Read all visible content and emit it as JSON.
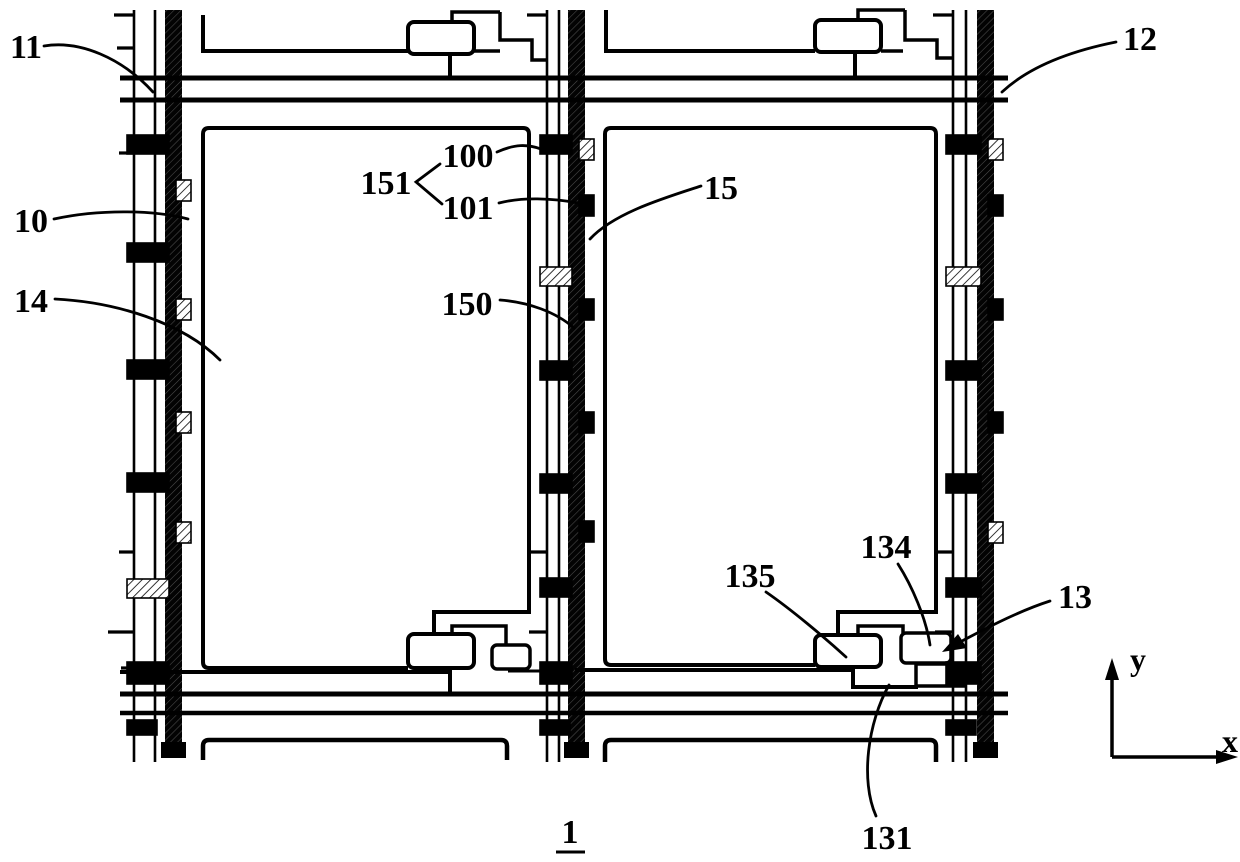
{
  "figure": {
    "number_label": "1",
    "axis_x": "x",
    "axis_y": "y"
  },
  "colors": {
    "ink": "#000000",
    "paper": "#ffffff"
  },
  "reference_labels": [
    {
      "id": "11",
      "text": "11",
      "cx": 26,
      "by": 58,
      "leader": "M 44,46 C 80,40 122,58 153,92"
    },
    {
      "id": "12",
      "text": "12",
      "cx": 1140,
      "by": 50,
      "leader": "M 1116,42 C 1076,50 1032,64 1002,92"
    },
    {
      "id": "10",
      "text": "10",
      "cx": 31,
      "by": 232,
      "leader": "M 54,219 C 100,209 155,210 188,219"
    },
    {
      "id": "14",
      "text": "14",
      "cx": 31,
      "by": 312,
      "leader": "M 55,299 C 115,302 182,322 220,360"
    },
    {
      "id": "151",
      "text": "151",
      "cx": 386,
      "by": 194,
      "leader": "M 440,164 L 416,182 L 442,204"
    },
    {
      "id": "100",
      "text": "100",
      "cx": 468,
      "by": 167,
      "leader": "M 497,152 C 515,144 527,144 541,149"
    },
    {
      "id": "101",
      "text": "101",
      "cx": 468,
      "by": 219,
      "leader": "M 499,203 C 522,197 552,198 578,203"
    },
    {
      "id": "15",
      "text": "15",
      "cx": 721,
      "by": 199,
      "leader": "M 701,186 C 664,198 614,213 590,239"
    },
    {
      "id": "150",
      "text": "150",
      "cx": 467,
      "by": 315,
      "leader": "M 500,300 C 528,302 556,312 574,328"
    },
    {
      "id": "135",
      "text": "135",
      "cx": 750,
      "by": 587,
      "leader": "M 766,592 C 792,610 824,637 846,657"
    },
    {
      "id": "134",
      "text": "134",
      "cx": 886,
      "by": 558,
      "leader": "M 898,564 C 912,586 926,618 930,645"
    },
    {
      "id": "13",
      "text": "13",
      "cx": 1075,
      "by": 608,
      "leader": "M 1050,601 C 1022,610 992,625 962,641",
      "arrow": "942,652 958,634 967,648"
    },
    {
      "id": "131",
      "text": "131",
      "cx": 887,
      "by": 849,
      "leader": "M 876,816 C 860,780 868,722 889,685"
    },
    {
      "id": "1",
      "text": "1",
      "cx": 570,
      "by": 843,
      "underline": [
        556,
        852,
        585
      ]
    }
  ],
  "columns": [
    {
      "id": "left",
      "t1": 134,
      "t2": 155,
      "T": 165,
      "pads": [
        {
          "y": 135
        },
        {
          "y": 243
        },
        {
          "y": 360
        },
        {
          "y": 473
        },
        {
          "y": 579,
          "style": "hatch"
        },
        {
          "y": 662,
          "h": 22
        },
        {
          "y": 720,
          "h": 15,
          "narrow": true
        }
      ],
      "squares": [
        {
          "y": 180,
          "style": "hatch"
        },
        {
          "y": 299,
          "style": "hatch"
        },
        {
          "y": 412,
          "style": "hatch"
        },
        {
          "y": 522,
          "style": "hatch"
        }
      ],
      "ticks": [
        {
          "y": 15,
          "len": 20
        },
        {
          "y": 48,
          "len": 17
        },
        {
          "y": 153,
          "len": 15
        },
        {
          "y": 552,
          "len": 15
        },
        {
          "y": 632,
          "len": 26
        },
        {
          "y": 668,
          "len": 13
        }
      ]
    },
    {
      "id": "middle",
      "t1": 547,
      "t2": 559,
      "T": 568,
      "pads": [
        {
          "y": 135
        },
        {
          "y": 267,
          "style": "hatch"
        },
        {
          "y": 361
        },
        {
          "y": 474
        },
        {
          "y": 578
        },
        {
          "y": 662,
          "h": 22
        },
        {
          "y": 720,
          "h": 15,
          "narrow": true
        }
      ],
      "squares": [
        {
          "y": 139,
          "style": "hatch"
        },
        {
          "y": 195
        },
        {
          "y": 299
        },
        {
          "y": 412
        },
        {
          "y": 521
        }
      ],
      "ticks": [
        {
          "y": 15,
          "len": 20
        },
        {
          "y": 552,
          "len": 18
        },
        {
          "y": 632,
          "len": 18
        }
      ]
    },
    {
      "id": "right",
      "t1": 953,
      "t2": 966,
      "T": 977,
      "pads": [
        {
          "y": 135
        },
        {
          "y": 267,
          "style": "hatch"
        },
        {
          "y": 361
        },
        {
          "y": 474
        },
        {
          "y": 578
        },
        {
          "y": 662,
          "h": 22
        },
        {
          "y": 720,
          "h": 15,
          "narrow": true
        }
      ],
      "squares": [
        {
          "y": 139,
          "style": "hatch"
        },
        {
          "y": 195
        },
        {
          "y": 299
        },
        {
          "y": 412
        },
        {
          "y": 522,
          "style": "hatch"
        }
      ],
      "ticks": [
        {
          "y": 15,
          "len": 20
        },
        {
          "y": 552,
          "len": 18
        },
        {
          "y": 632,
          "len": 18
        }
      ]
    }
  ]
}
